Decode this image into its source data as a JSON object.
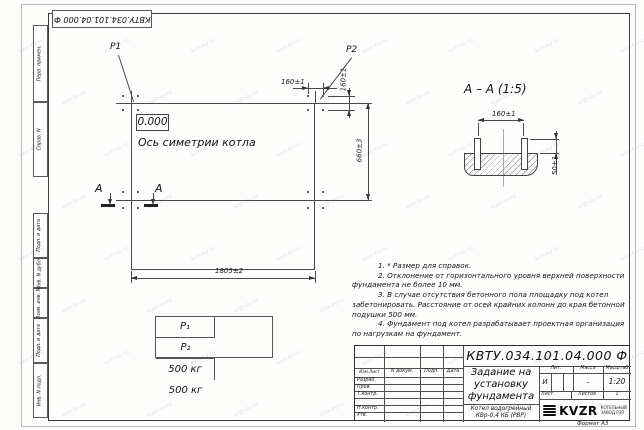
{
  "watermark": {
    "text": "kvzr-kv.ru"
  },
  "frame": {
    "doc_number_top": "КВТУ.034.101.04.000  Ф",
    "margin_labels": [
      "Перв. примен.",
      "Справ. N",
      "Подп. и дата",
      "Инв. N дубл.",
      "Взам. инв. N",
      "Подп. и дата",
      "Инв. N подл."
    ],
    "format_note": "Формат А3"
  },
  "plan": {
    "p1": "P1",
    "p2": "P2",
    "level_mark": "0.000",
    "axis_label": "Ось симетрии котла",
    "dim_bolt_spacing_h": "160±1",
    "dim_bolt_spacing_v": "160±1",
    "dim_length": "1805±2",
    "dim_width": "660±3",
    "section_letter_left": "А",
    "section_letter_right": "А"
  },
  "section_view": {
    "title": "А – А (1:5)",
    "dim_bolt_spacing": "160±1",
    "dim_protrusion": "50±1"
  },
  "loads_table": {
    "col1_header": "P₁",
    "col2_header": "P₂",
    "col1_value": "500 кг",
    "col2_value": "500 кг"
  },
  "notes": {
    "lines": [
      "1. * Размер для справок.",
      "2. Отклонение от горизонтального уровня верхней поверхности",
      "фундамента не более 10 мм.",
      "3. В случае отсутствия бетонного пола площадку под котел",
      "забетонировать. Расстояние от осей крайних колонн до края бетонной",
      "подушки 500 мм.",
      "4. Фундамент под котел разрабатывает проектная организация",
      "по нагрузкам на фундамент."
    ]
  },
  "title_block": {
    "doc_number": "КВТУ.034.101.04.000  Ф",
    "title_lines": [
      "Задание на",
      "установку",
      "фундамента"
    ],
    "product_lines": [
      "Котел водогрейный",
      "КВр-0,4  КБ  (РВР)"
    ],
    "col_izm": "Изм.Лист",
    "col_doc": "N докум.",
    "col_sign": "Подп.",
    "col_date": "Дата",
    "row_razrab": "Разраб.",
    "row_prov": "Пров.",
    "row_tkontr": "Т.контр.",
    "row_nkontr": "Н.контр.",
    "row_utv": "Утв.",
    "lit_header": "Лит.",
    "mass_header": "Масса",
    "scale_header": "Масштаб",
    "lit_value": "И",
    "mass_value": "–",
    "scale_value": "1:20",
    "sheet_label": "Лист.",
    "sheets_label": "Листов",
    "sheets_value": "1",
    "logo_text": "KVZR",
    "logo_caption": [
      "КОТЕЛЬНЫЙ",
      "ЗАВОД РЭП"
    ]
  }
}
